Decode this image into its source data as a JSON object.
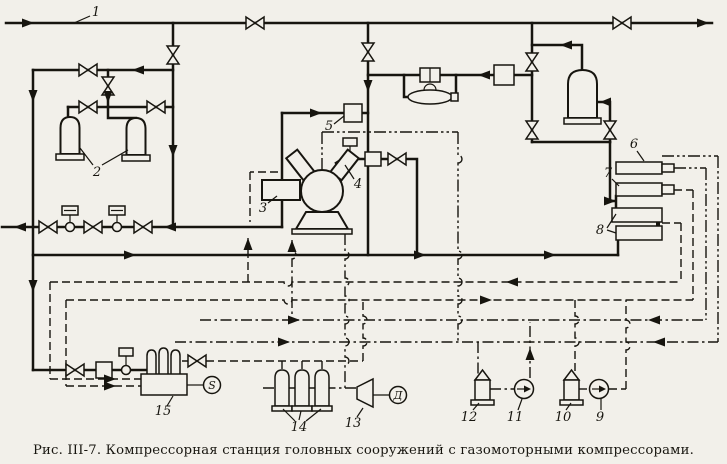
{
  "figure": {
    "caption": "Рис. III-7. Компрессорная станция головных сооружений с газомоторными компрессорами."
  },
  "colors": {
    "ink": "#17150f",
    "paper": "#f2f0ea"
  },
  "part_labels": {
    "n1": "1",
    "n2": "2",
    "n3": "3",
    "n4": "4",
    "n5": "5",
    "n6": "6",
    "n7": "7",
    "n8": "8",
    "n9": "9",
    "n10": "10",
    "n11": "11",
    "n12": "12",
    "n13": "13",
    "n14": "14",
    "n15": "15"
  },
  "device_letters": {
    "motor": "Д",
    "generator": "S"
  },
  "symbols": {
    "gate-valve-icon": "bowtie",
    "control-valve-icon": "circle-with-actuator-hat",
    "separator-vessel-icon": "dome-top-cylinder",
    "compressor-icon": "circle-with-v-cylinders",
    "cooler-section-icon": "horizontal-rectangle",
    "pump-icon": "circle-with-flow-arrow",
    "fan-icon": "widening-trapezoid",
    "flow-meter-icon": "oval-on-bypass",
    "engine-generator-icon": "block-with-cylinders-and-s-circle"
  }
}
